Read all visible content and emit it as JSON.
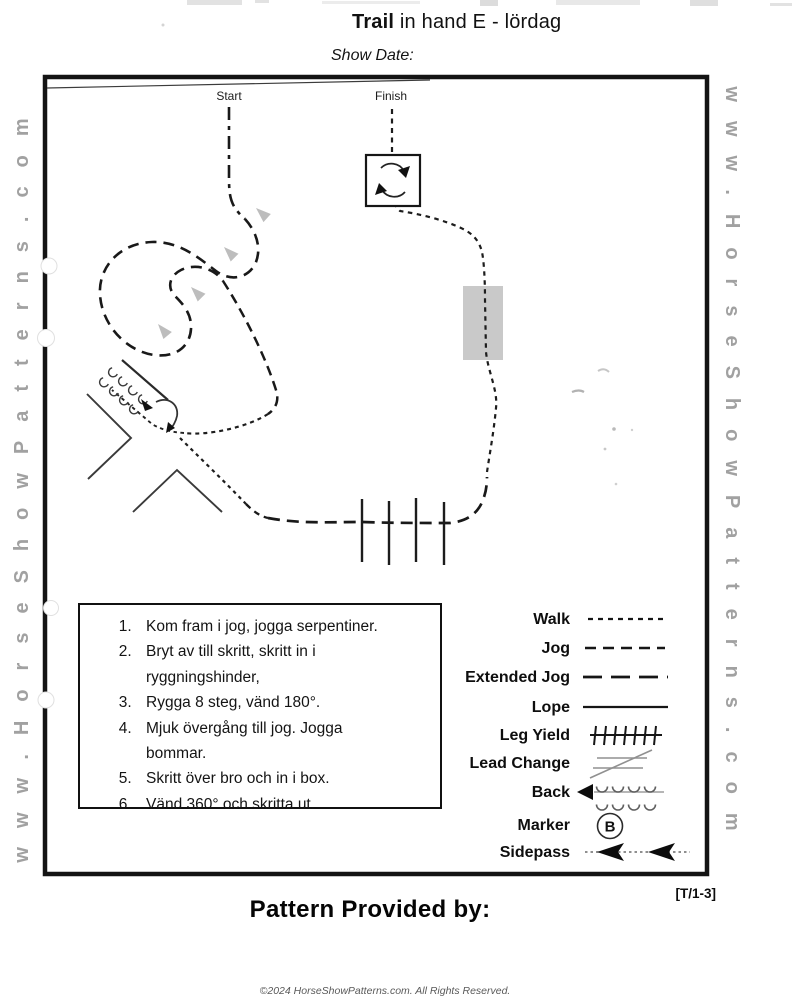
{
  "title": {
    "bold": "Trail",
    "rest": " in hand E - lördag"
  },
  "show_date": {
    "label": "Show Date:"
  },
  "watermarks": {
    "left": "www.HorseShowPatterns.com",
    "right": "www.HorseShowPatterns.com"
  },
  "arena": {
    "start_label": "Start",
    "finish_label": "Finish"
  },
  "instructions": {
    "items": [
      "Kom fram i jog, jogga serpentiner.",
      "Bryt av till skritt, skritt in i ryggningshinder,",
      "Rygga 8 steg, vänd 180°.",
      "Mjuk övergång till jog. Jogga bommar.",
      "Skritt över bro och in i box.",
      "Vänd 360° och skritta ut."
    ]
  },
  "legend": {
    "marker_letter": "B",
    "items": [
      {
        "label": "Walk"
      },
      {
        "label": "Jog"
      },
      {
        "label": "Extended Jog"
      },
      {
        "label": "Lope"
      },
      {
        "label": "Leg Yield"
      },
      {
        "label": "Lead Change"
      },
      {
        "label": "Back"
      },
      {
        "label": "Marker"
      },
      {
        "label": "Sidepass"
      }
    ]
  },
  "footer": {
    "pattern_code": "[T/1-3]",
    "provided_by": "Pattern Provided by:",
    "copyright": "©2024 HorseShowPatterns.com. All Rights Reserved."
  },
  "colors": {
    "ink": "#1a1a1a",
    "bridge_gray": "#c9c9c9",
    "arrow_gray": "#bdbdbd",
    "watermark_gray": "#a1a1a1"
  }
}
